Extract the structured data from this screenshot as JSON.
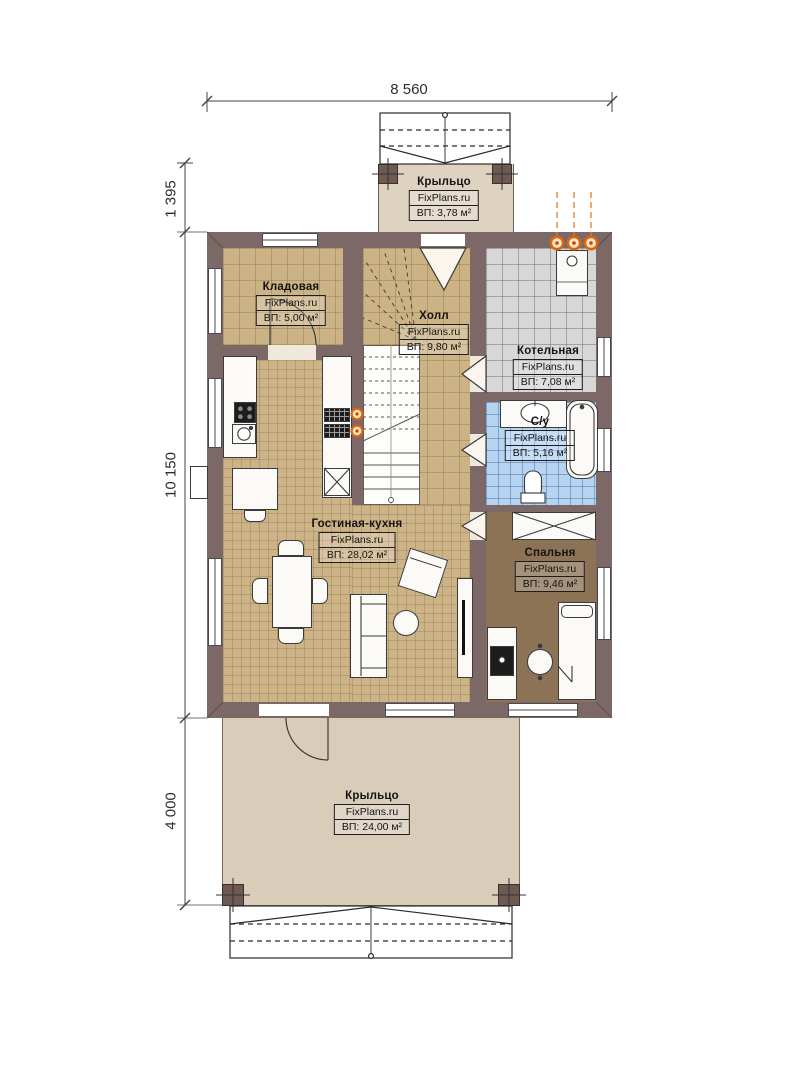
{
  "brand": "FixPlans.ru",
  "dimensions": {
    "overall_width": "8 560",
    "porch_top_depth": "1 395",
    "house_depth": "10 150",
    "porch_bottom_depth": "4 000"
  },
  "rooms": {
    "porch_top": {
      "name": "Крыльцо",
      "area": "ВП: 3,78 м²"
    },
    "storage": {
      "name": "Кладовая",
      "area": "ВП: 5,00 м²"
    },
    "hall": {
      "name": "Холл",
      "area": "ВП: 9,80 м²"
    },
    "boiler": {
      "name": "Котельная",
      "area": "ВП: 7,08 м²"
    },
    "bathroom": {
      "name": "С/у",
      "area": "ВП: 5,16 м²"
    },
    "living_kitchen": {
      "name": "Гостиная-кухня",
      "area": "ВП: 28,02 м²"
    },
    "bedroom": {
      "name": "Спальня",
      "area": "ВП: 9,46 м²"
    },
    "porch_bottom": {
      "name": "Крыльцо",
      "area": "ВП: 24,00 м²"
    }
  },
  "colors": {
    "wall": "#7c6867",
    "floor_tan": "#ccb386",
    "floor_boiler": "#d7d7d7",
    "floor_bath": "#b6d4f0",
    "floor_bedroom": "#8d7356",
    "porch": "#d9ccb9",
    "gas_accent": "#e87a20"
  }
}
